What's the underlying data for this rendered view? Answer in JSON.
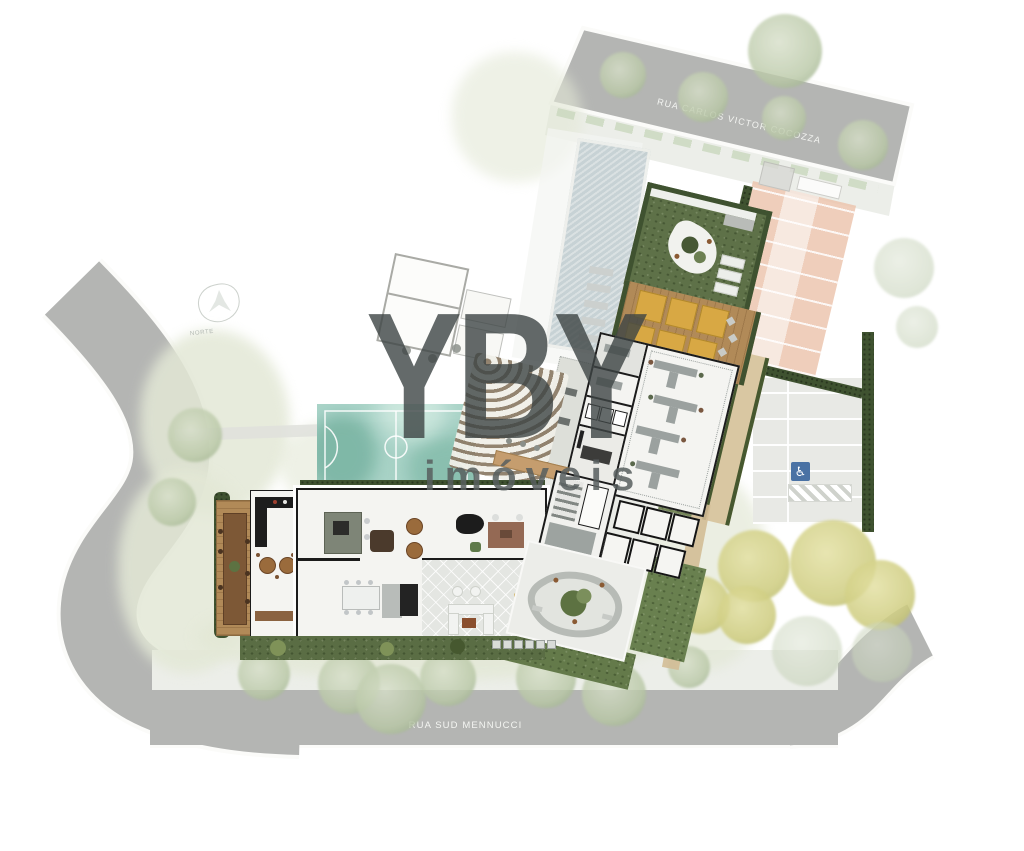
{
  "streets": {
    "top_label": "RUA CARLOS VICTOR COCOZZA",
    "bottom_label": "RUA SUD MENNUCCI"
  },
  "compass": {
    "label": "NORTE"
  },
  "watermark": {
    "brand": "YBY",
    "tagline": "imóveis"
  },
  "icons": {
    "accessible_parking": "♿"
  },
  "palette": {
    "street_gray": "#b4b5b3",
    "street_label": "#f4f5f2",
    "sidewalk": "#eceee9",
    "lawn_faded": "#e3e8d6",
    "lawn_vivid": "#5e7148",
    "hedge_dark": "#3f5230",
    "deck_wood": "#b18a58",
    "lounger_yellow": "#d8a844",
    "court_teal": "#a6d2c6",
    "pool_blue": "#bcc9cd",
    "parking_salmon": "#ecc3ab",
    "floor_white": "#f4f4f1",
    "wall_black": "#1b1b1b",
    "walkway_tan": "#d9c7a2",
    "accessible_blue": "#4a72a4",
    "watermark_dark": "#3e4545"
  }
}
